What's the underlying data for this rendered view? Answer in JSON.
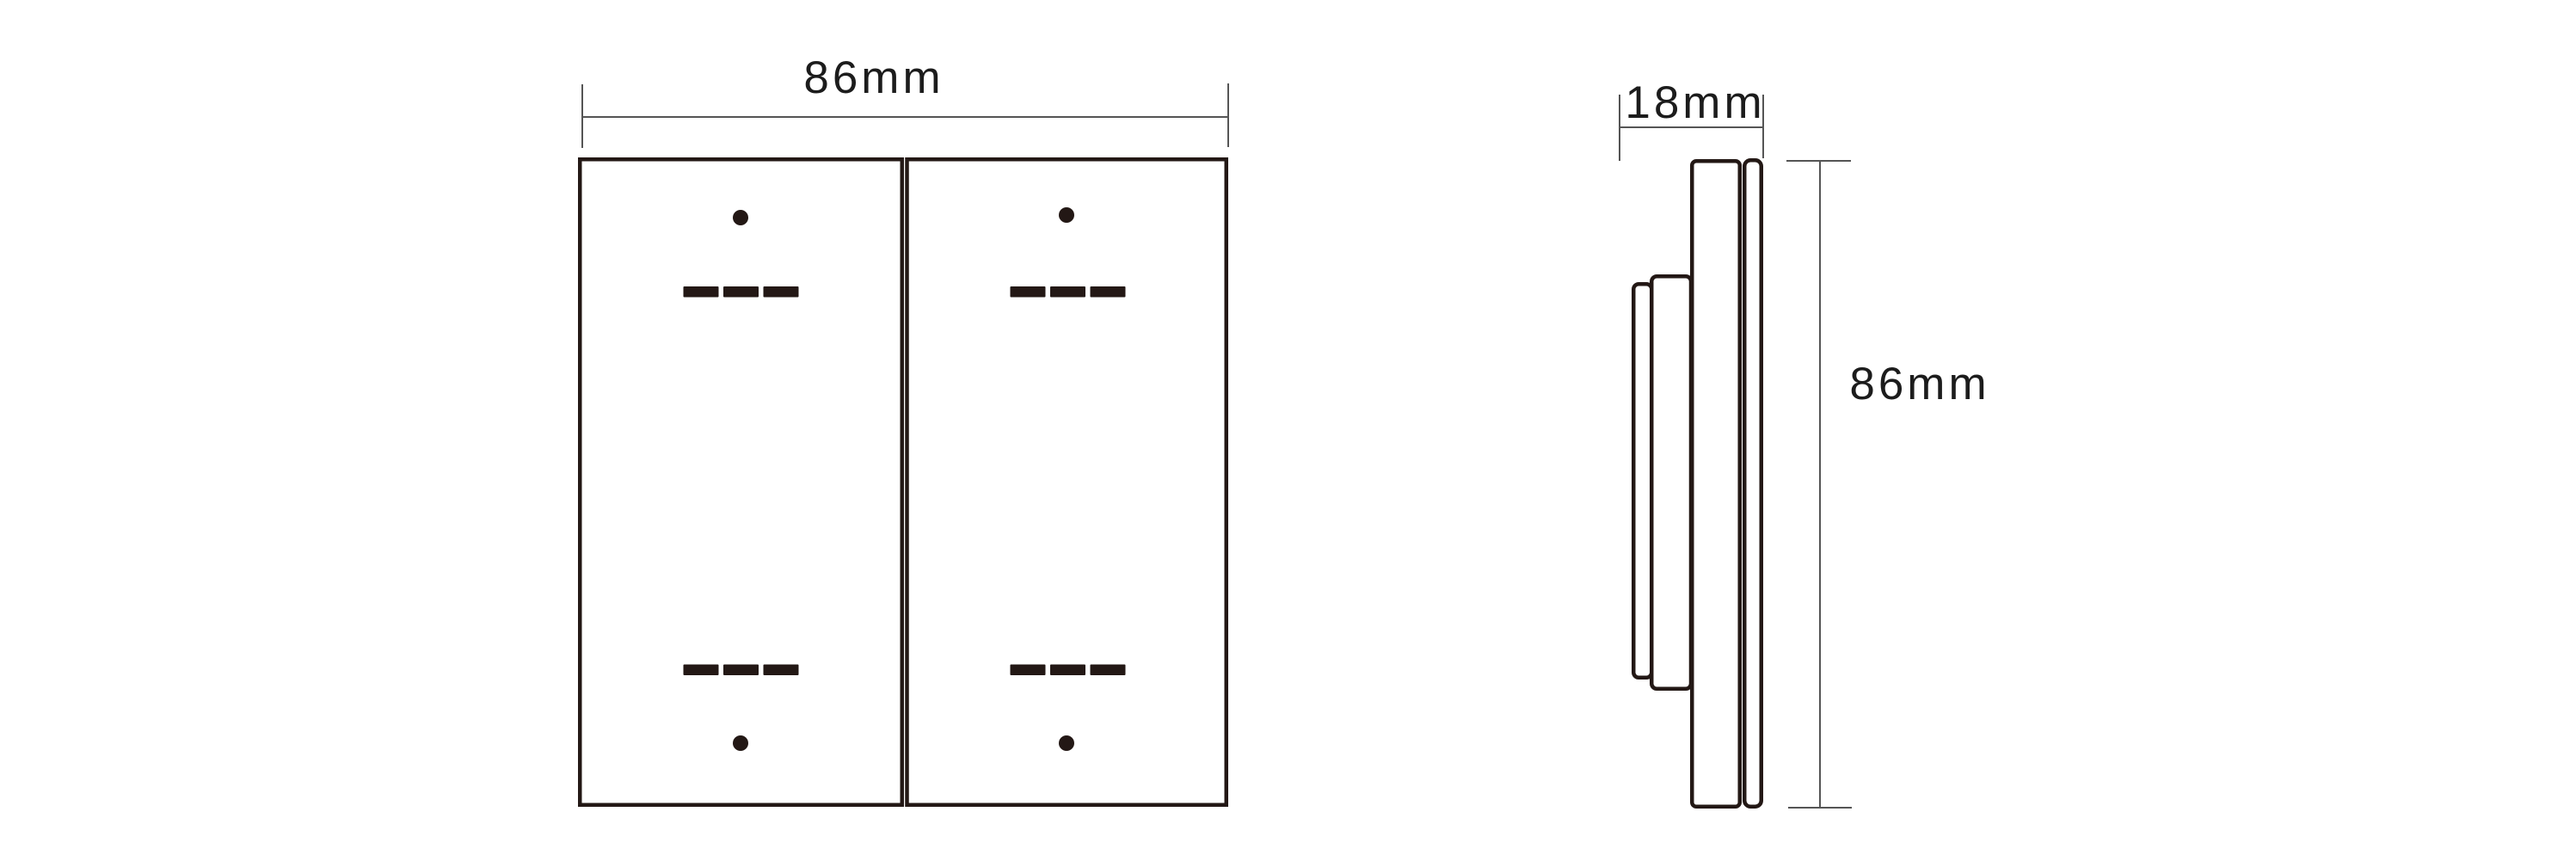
{
  "labels": {
    "front_width": "86mm",
    "side_depth": "18mm",
    "side_height": "86mm"
  },
  "colors": {
    "outline": "#231815",
    "dimension": "#555555",
    "text": "#1c1c1c",
    "background": "#ffffff"
  },
  "front_view": {
    "gang_count": 2,
    "marks_per_gang": {
      "top": [
        "dot",
        "three-dashes"
      ],
      "bottom": [
        "three-dashes",
        "dot"
      ]
    }
  }
}
